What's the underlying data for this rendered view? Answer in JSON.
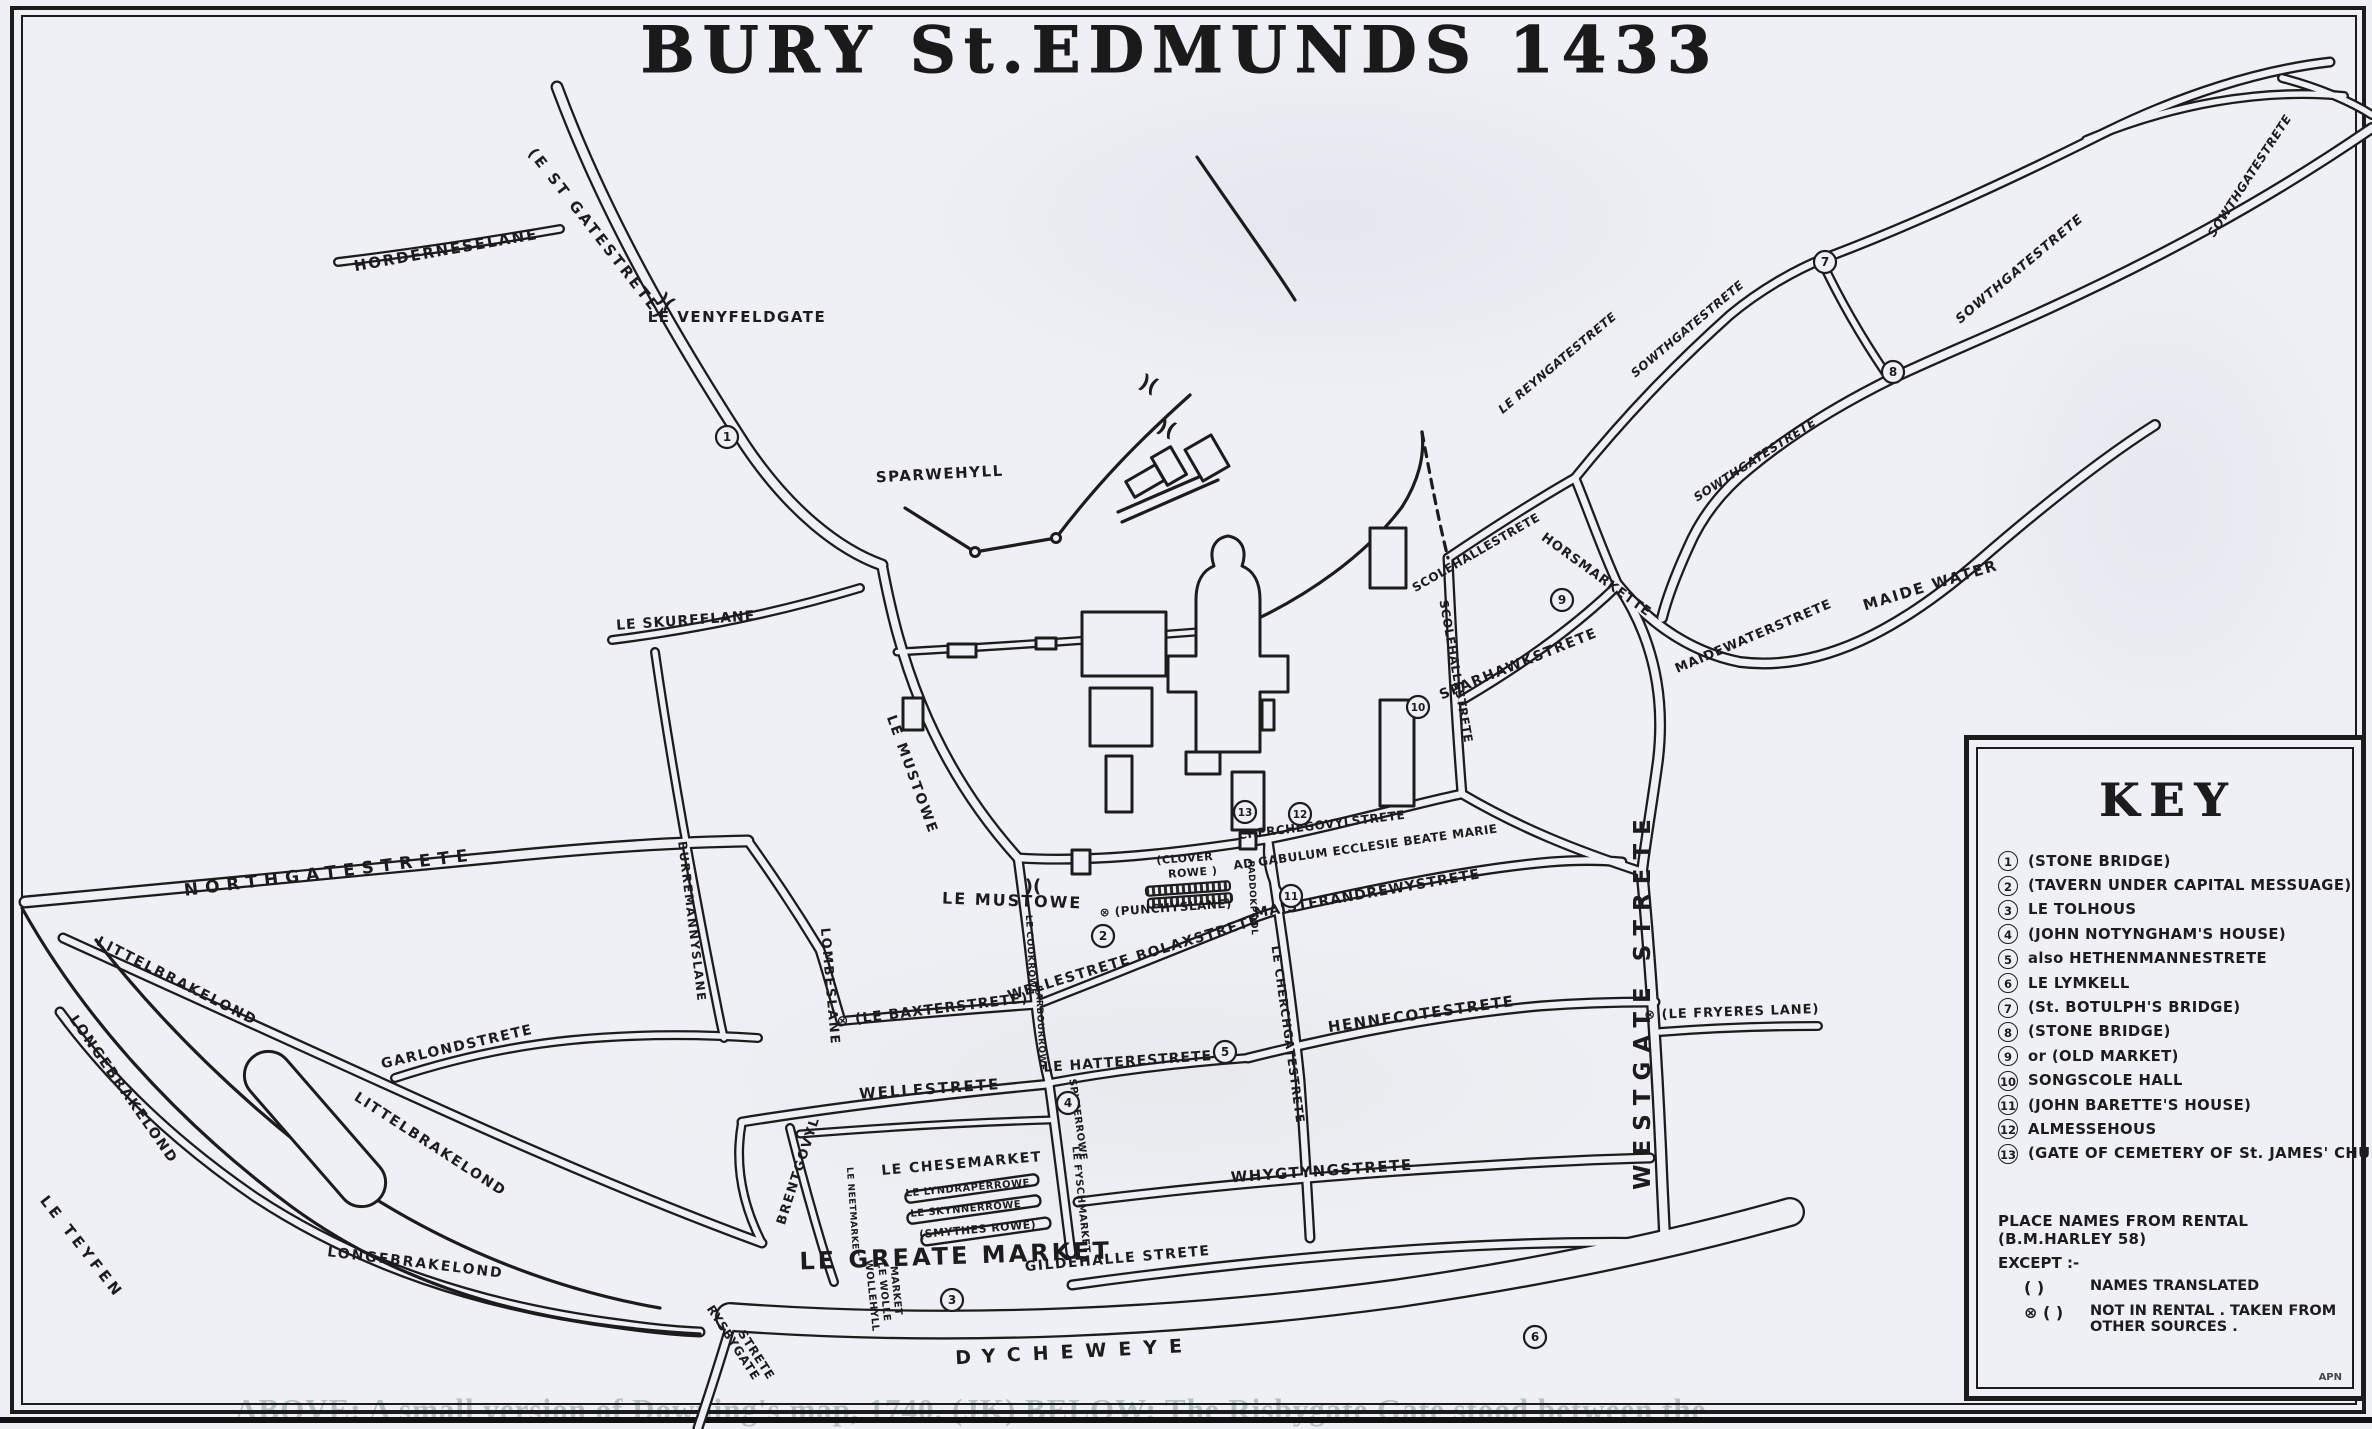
{
  "title": "BURY St.EDMUNDS 1433",
  "colors": {
    "ink": "#1c1c1c",
    "paper": "#eef0f5"
  },
  "key": {
    "title": "KEY",
    "entries": [
      {
        "num": "1",
        "label": "(STONE BRIDGE)"
      },
      {
        "num": "2",
        "label": "(TAVERN UNDER CAPITAL MESSUAGE)"
      },
      {
        "num": "3",
        "label": "LE TOLHOUS"
      },
      {
        "num": "4",
        "label": "(JOHN NOTYNGHAM'S HOUSE)"
      },
      {
        "num": "5",
        "label": "also HETHENMANNESTRETE"
      },
      {
        "num": "6",
        "label": "LE LYMKELL"
      },
      {
        "num": "7",
        "label": "(St. BOTULPH'S BRIDGE)"
      },
      {
        "num": "8",
        "label": "(STONE BRIDGE)"
      },
      {
        "num": "9",
        "label": "or (OLD MARKET)"
      },
      {
        "num": "10",
        "label": "SONGSCOLE HALL"
      },
      {
        "num": "11",
        "label": "(JOHN BARETTE'S HOUSE)"
      },
      {
        "num": "12",
        "label": "ALMESSEHOUS"
      },
      {
        "num": "13",
        "label": "(GATE OF CEMETERY OF St. JAMES' CHURCH)"
      }
    ],
    "source_note": "PLACE NAMES FROM RENTAL (B.M.HARLEY 58)",
    "except_note": "EXCEPT :-",
    "legend": [
      {
        "symbol": "(   )",
        "label": "NAMES TRANSLATED"
      },
      {
        "symbol": "⊗ (  )",
        "label": "NOT IN RENTAL . TAKEN FROM OTHER SOURCES ."
      }
    ],
    "signature": "APN"
  },
  "street_labels": [
    {
      "t": "HORDERNESELANE",
      "x": 447,
      "y": 255,
      "r": -10,
      "s": 15,
      "sp": 2
    },
    {
      "t": "(E ST GATESTRETE)",
      "x": 593,
      "y": 237,
      "r": 52,
      "s": 15,
      "sp": 3
    },
    {
      "t": "LE VENYFELDGATE",
      "x": 737,
      "y": 322,
      "r": 0,
      "s": 15,
      "sp": 1.5
    },
    {
      "t": "SPARWEHYLL",
      "x": 940,
      "y": 479,
      "r": -3,
      "s": 15,
      "sp": 1.5
    },
    {
      "t": "LE SKURFFLANE",
      "x": 686,
      "y": 625,
      "r": -4,
      "s": 14,
      "sp": 1
    },
    {
      "t": "NORTHGATESTRETE",
      "x": 330,
      "y": 878,
      "r": -7,
      "s": 17,
      "sp": 7
    },
    {
      "t": "BURREMANNYSLANE",
      "x": 688,
      "y": 922,
      "r": 83,
      "s": 12,
      "sp": 1.5
    },
    {
      "t": "LITTELBRAKELOND",
      "x": 175,
      "y": 985,
      "r": 27,
      "s": 14,
      "sp": 2
    },
    {
      "t": "LONGEBRAKELOND",
      "x": 120,
      "y": 1092,
      "r": 55,
      "s": 14,
      "sp": 2
    },
    {
      "t": "LITTELBRAKELOND",
      "x": 428,
      "y": 1148,
      "r": 33,
      "s": 14,
      "sp": 2
    },
    {
      "t": "LONGEBRAKELOND",
      "x": 415,
      "y": 1267,
      "r": 7,
      "s": 14,
      "sp": 2
    },
    {
      "t": "GARLONDSTRETE",
      "x": 458,
      "y": 1051,
      "r": -13,
      "s": 14,
      "sp": 1.5
    },
    {
      "t": "LE TEYFEN",
      "x": 78,
      "y": 1250,
      "r": 52,
      "s": 15,
      "sp": 4
    },
    {
      "t": "LOMBESLANE",
      "x": 826,
      "y": 987,
      "r": 85,
      "s": 13,
      "sp": 2
    },
    {
      "t": "LE MUSTOWE",
      "x": 908,
      "y": 776,
      "r": 70,
      "s": 14,
      "sp": 2
    },
    {
      "t": "LE MUSTOWE",
      "x": 1012,
      "y": 906,
      "r": 2,
      "s": 16,
      "sp": 2
    },
    {
      "t": "⊗ (LE BAXTERSTRETE)",
      "x": 933,
      "y": 1014,
      "r": -7,
      "s": 14,
      "sp": 1
    },
    {
      "t": "LE COOKROWE",
      "x": 1028,
      "y": 955,
      "r": 87,
      "s": 9,
      "sp": 0.5
    },
    {
      "t": "BARBOURROWE",
      "x": 1038,
      "y": 1028,
      "r": 87,
      "s": 9,
      "sp": 0.5
    },
    {
      "t": "WELLESTRETE  BOLAXSTRETE",
      "x": 1135,
      "y": 962,
      "r": -17,
      "s": 14,
      "sp": 1.5
    },
    {
      "t": "LE HATTERESTRETE",
      "x": 1128,
      "y": 1066,
      "r": -4,
      "s": 14,
      "sp": 1
    },
    {
      "t": "WELLESTRETE",
      "x": 930,
      "y": 1094,
      "r": -4,
      "s": 15,
      "sp": 2
    },
    {
      "t": "BRENTGOVYL",
      "x": 802,
      "y": 1172,
      "r": -72,
      "s": 13,
      "sp": 1.5
    },
    {
      "t": "LE NEETMARKET",
      "x": 850,
      "y": 1212,
      "r": 86,
      "s": 9,
      "sp": 0.5
    },
    {
      "t": "LE CHESEMARKET",
      "x": 962,
      "y": 1168,
      "r": -5,
      "s": 14,
      "sp": 1.5
    },
    {
      "t": "LE LYNDRAPERROWE",
      "x": 968,
      "y": 1191,
      "r": -5,
      "s": 10,
      "sp": 0.5
    },
    {
      "t": "LE SKYNNERROWE",
      "x": 966,
      "y": 1212,
      "r": -5,
      "s": 10,
      "sp": 0.5
    },
    {
      "t": "(SMYTHES ROWE)",
      "x": 978,
      "y": 1233,
      "r": -5,
      "s": 11,
      "sp": 0.5
    },
    {
      "t": "LE  GREATE  MARKET",
      "x": 956,
      "y": 1264,
      "r": -2,
      "s": 24,
      "sp": 3
    },
    {
      "t": "WOLLEHYLL",
      "x": 869,
      "y": 1296,
      "r": 84,
      "s": 10,
      "sp": 0.5
    },
    {
      "t": "LE WOLLE",
      "x": 881,
      "y": 1292,
      "r": 84,
      "s": 10,
      "sp": 0.5
    },
    {
      "t": "MARKET",
      "x": 893,
      "y": 1291,
      "r": 84,
      "s": 10,
      "sp": 0.5
    },
    {
      "t": "SPYCERROWE",
      "x": 1075,
      "y": 1120,
      "r": 82,
      "s": 10,
      "sp": 0.5
    },
    {
      "t": "LE FYSCHMARKET",
      "x": 1078,
      "y": 1200,
      "r": 84,
      "s": 10,
      "sp": 0.5
    },
    {
      "t": "DYCHEWEYE",
      "x": 1075,
      "y": 1358,
      "r": -3,
      "s": 19,
      "sp": 12
    },
    {
      "t": "RYSBYGATE",
      "x": 730,
      "y": 1345,
      "r": 57,
      "s": 12,
      "sp": 1
    },
    {
      "t": "STRETE",
      "x": 753,
      "y": 1357,
      "r": 57,
      "s": 12,
      "sp": 1
    },
    {
      "t": "GILDEHALLE STRETE",
      "x": 1118,
      "y": 1263,
      "r": -5,
      "s": 14,
      "sp": 1.5
    },
    {
      "t": "WHYGTYNGSTRETE",
      "x": 1322,
      "y": 1176,
      "r": -4,
      "s": 15,
      "sp": 1.5
    },
    {
      "t": "HENNECOTESTRETE",
      "x": 1422,
      "y": 1019,
      "r": -8,
      "s": 15,
      "sp": 1.5
    },
    {
      "t": "MAISTERANDREWYSTRETE",
      "x": 1368,
      "y": 898,
      "r": -10,
      "s": 14,
      "sp": 1
    },
    {
      "t": "CHERCHEGOVYLSTRETE",
      "x": 1322,
      "y": 829,
      "r": -7,
      "s": 12,
      "sp": 0.5
    },
    {
      "t": "AD GABULUM ECCLESIE BEATE MARIE",
      "x": 1366,
      "y": 851,
      "r": -8,
      "s": 12,
      "sp": 0.5
    },
    {
      "t": "(CLOVER",
      "x": 1185,
      "y": 862,
      "r": -4,
      "s": 11,
      "sp": 0.5
    },
    {
      "t": "ROWE )",
      "x": 1193,
      "y": 876,
      "r": -4,
      "s": 11,
      "sp": 0.5
    },
    {
      "t": "⊗ (PUNCHYSLANE)",
      "x": 1166,
      "y": 912,
      "r": -4,
      "s": 12,
      "sp": 0.5
    },
    {
      "t": "PADDOKPOOL",
      "x": 1250,
      "y": 898,
      "r": 87,
      "s": 9,
      "sp": 0.5
    },
    {
      "t": "LE CHERCHGATESTRETE",
      "x": 1284,
      "y": 1035,
      "r": 82,
      "s": 12,
      "sp": 1
    },
    {
      "t": "WESTGATE STRETE",
      "x": 1650,
      "y": 1000,
      "r": -90,
      "s": 23,
      "sp": 9
    },
    {
      "t": "⊗ (LE FRYERES LANE)",
      "x": 1732,
      "y": 1016,
      "r": -2,
      "s": 13,
      "sp": 1
    },
    {
      "t": "SCOLEHALLESTRETE",
      "x": 1478,
      "y": 556,
      "r": -30,
      "s": 12,
      "sp": 0.5
    },
    {
      "t": "SCOLEHALLESTRETE",
      "x": 1452,
      "y": 672,
      "r": 80,
      "s": 12,
      "sp": 0.5
    },
    {
      "t": "SPARHAWKSTRETE",
      "x": 1520,
      "y": 668,
      "r": -22,
      "s": 14,
      "sp": 1.5
    },
    {
      "t": "HORSMARKETTE",
      "x": 1594,
      "y": 578,
      "r": 36,
      "s": 13,
      "sp": 1
    },
    {
      "t": "SOWTHGATESTRETE",
      "x": 1690,
      "y": 332,
      "r": -40,
      "s": 12,
      "sp": 0.5,
      "it": 1
    },
    {
      "t": "SOWTHGATESTRETE",
      "x": 1757,
      "y": 463,
      "r": -33,
      "s": 12,
      "sp": 0.5,
      "it": 1
    },
    {
      "t": "SOWTHGATESTRETE",
      "x": 2022,
      "y": 272,
      "r": -40,
      "s": 13,
      "sp": 1,
      "it": 1
    },
    {
      "t": "SOWTHGATESTRETE",
      "x": 2253,
      "y": 178,
      "r": -57,
      "s": 12,
      "sp": 0.5,
      "it": 1
    },
    {
      "t": "LE REYNGATESTRETE",
      "x": 1560,
      "y": 366,
      "r": -40,
      "s": 12,
      "sp": 0.5,
      "it": 1
    },
    {
      "t": "MAIDEWATERSTRETE",
      "x": 1755,
      "y": 640,
      "r": -23,
      "s": 13,
      "sp": 1
    },
    {
      "t": "MAIDE WATER",
      "x": 1932,
      "y": 590,
      "r": -17,
      "s": 15,
      "sp": 2
    }
  ],
  "markers": [
    {
      "n": "1",
      "x": 727,
      "y": 437
    },
    {
      "n": "2",
      "x": 1103,
      "y": 936
    },
    {
      "n": "3",
      "x": 952,
      "y": 1300
    },
    {
      "n": "4",
      "x": 1068,
      "y": 1103
    },
    {
      "n": "5",
      "x": 1225,
      "y": 1052
    },
    {
      "n": "6",
      "x": 1535,
      "y": 1337
    },
    {
      "n": "7",
      "x": 1825,
      "y": 262
    },
    {
      "n": "8",
      "x": 1893,
      "y": 372
    },
    {
      "n": "9",
      "x": 1562,
      "y": 600
    },
    {
      "n": "10",
      "x": 1418,
      "y": 707
    },
    {
      "n": "11",
      "x": 1291,
      "y": 896
    },
    {
      "n": "12",
      "x": 1300,
      "y": 814
    },
    {
      "n": "13",
      "x": 1245,
      "y": 812
    }
  ],
  "gate_glyphs": [
    {
      "t": ")(",
      "x": 662,
      "y": 306,
      "r": 40,
      "s": 18
    },
    {
      "t": ")(",
      "x": 1146,
      "y": 390,
      "r": 25,
      "s": 20
    },
    {
      "t": ")(",
      "x": 1164,
      "y": 434,
      "r": 25,
      "s": 20
    },
    {
      "t": ")(",
      "x": 1033,
      "y": 892,
      "r": 0,
      "s": 18
    }
  ],
  "ghost_text": "ABOVE: A small version of Downing's map, 1740. (JK) BELOW: The Risbygate Gate stood between the"
}
